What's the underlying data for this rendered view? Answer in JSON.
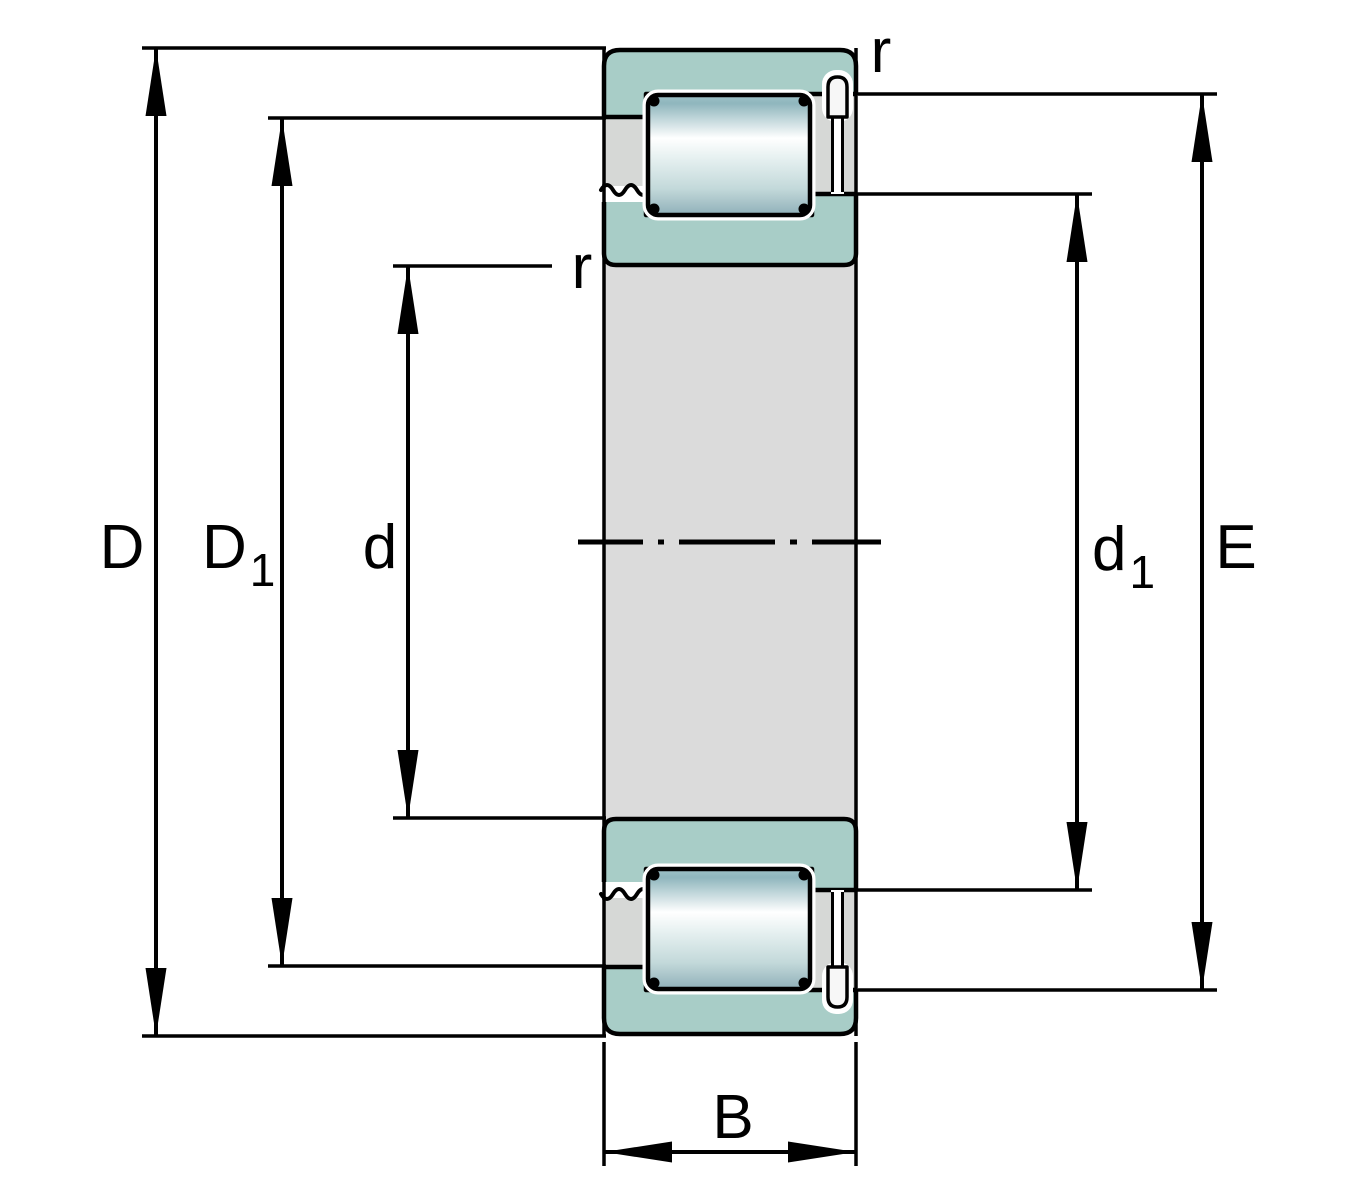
{
  "drawing": {
    "title": "Cylindrical roller bearing cross-section with dimension annotations"
  },
  "labels": {
    "D": "D",
    "D1_main": "D",
    "D1_sub": "1",
    "d": "d",
    "d1_main": "d",
    "d1_sub": "1",
    "E": "E",
    "B": "B",
    "r_outer": "r",
    "r_inner": "r"
  },
  "colors": {
    "ring_teal": "#a8cdc7",
    "cage_gray": "#d6d8d6",
    "bore_gray": "#dbdbdb",
    "outline_black": "#000000",
    "pin_white": "#f7f7f7",
    "roller_grad_top": "#9fc2c8",
    "roller_grad_dark": "#8fb6bd",
    "roller_grad_light": "#ffffff",
    "roller_grad_mid": "#e7f1f1",
    "roller_grad_low": "#c3d9da",
    "roller_grad_bottom": "#8fb0b9"
  }
}
